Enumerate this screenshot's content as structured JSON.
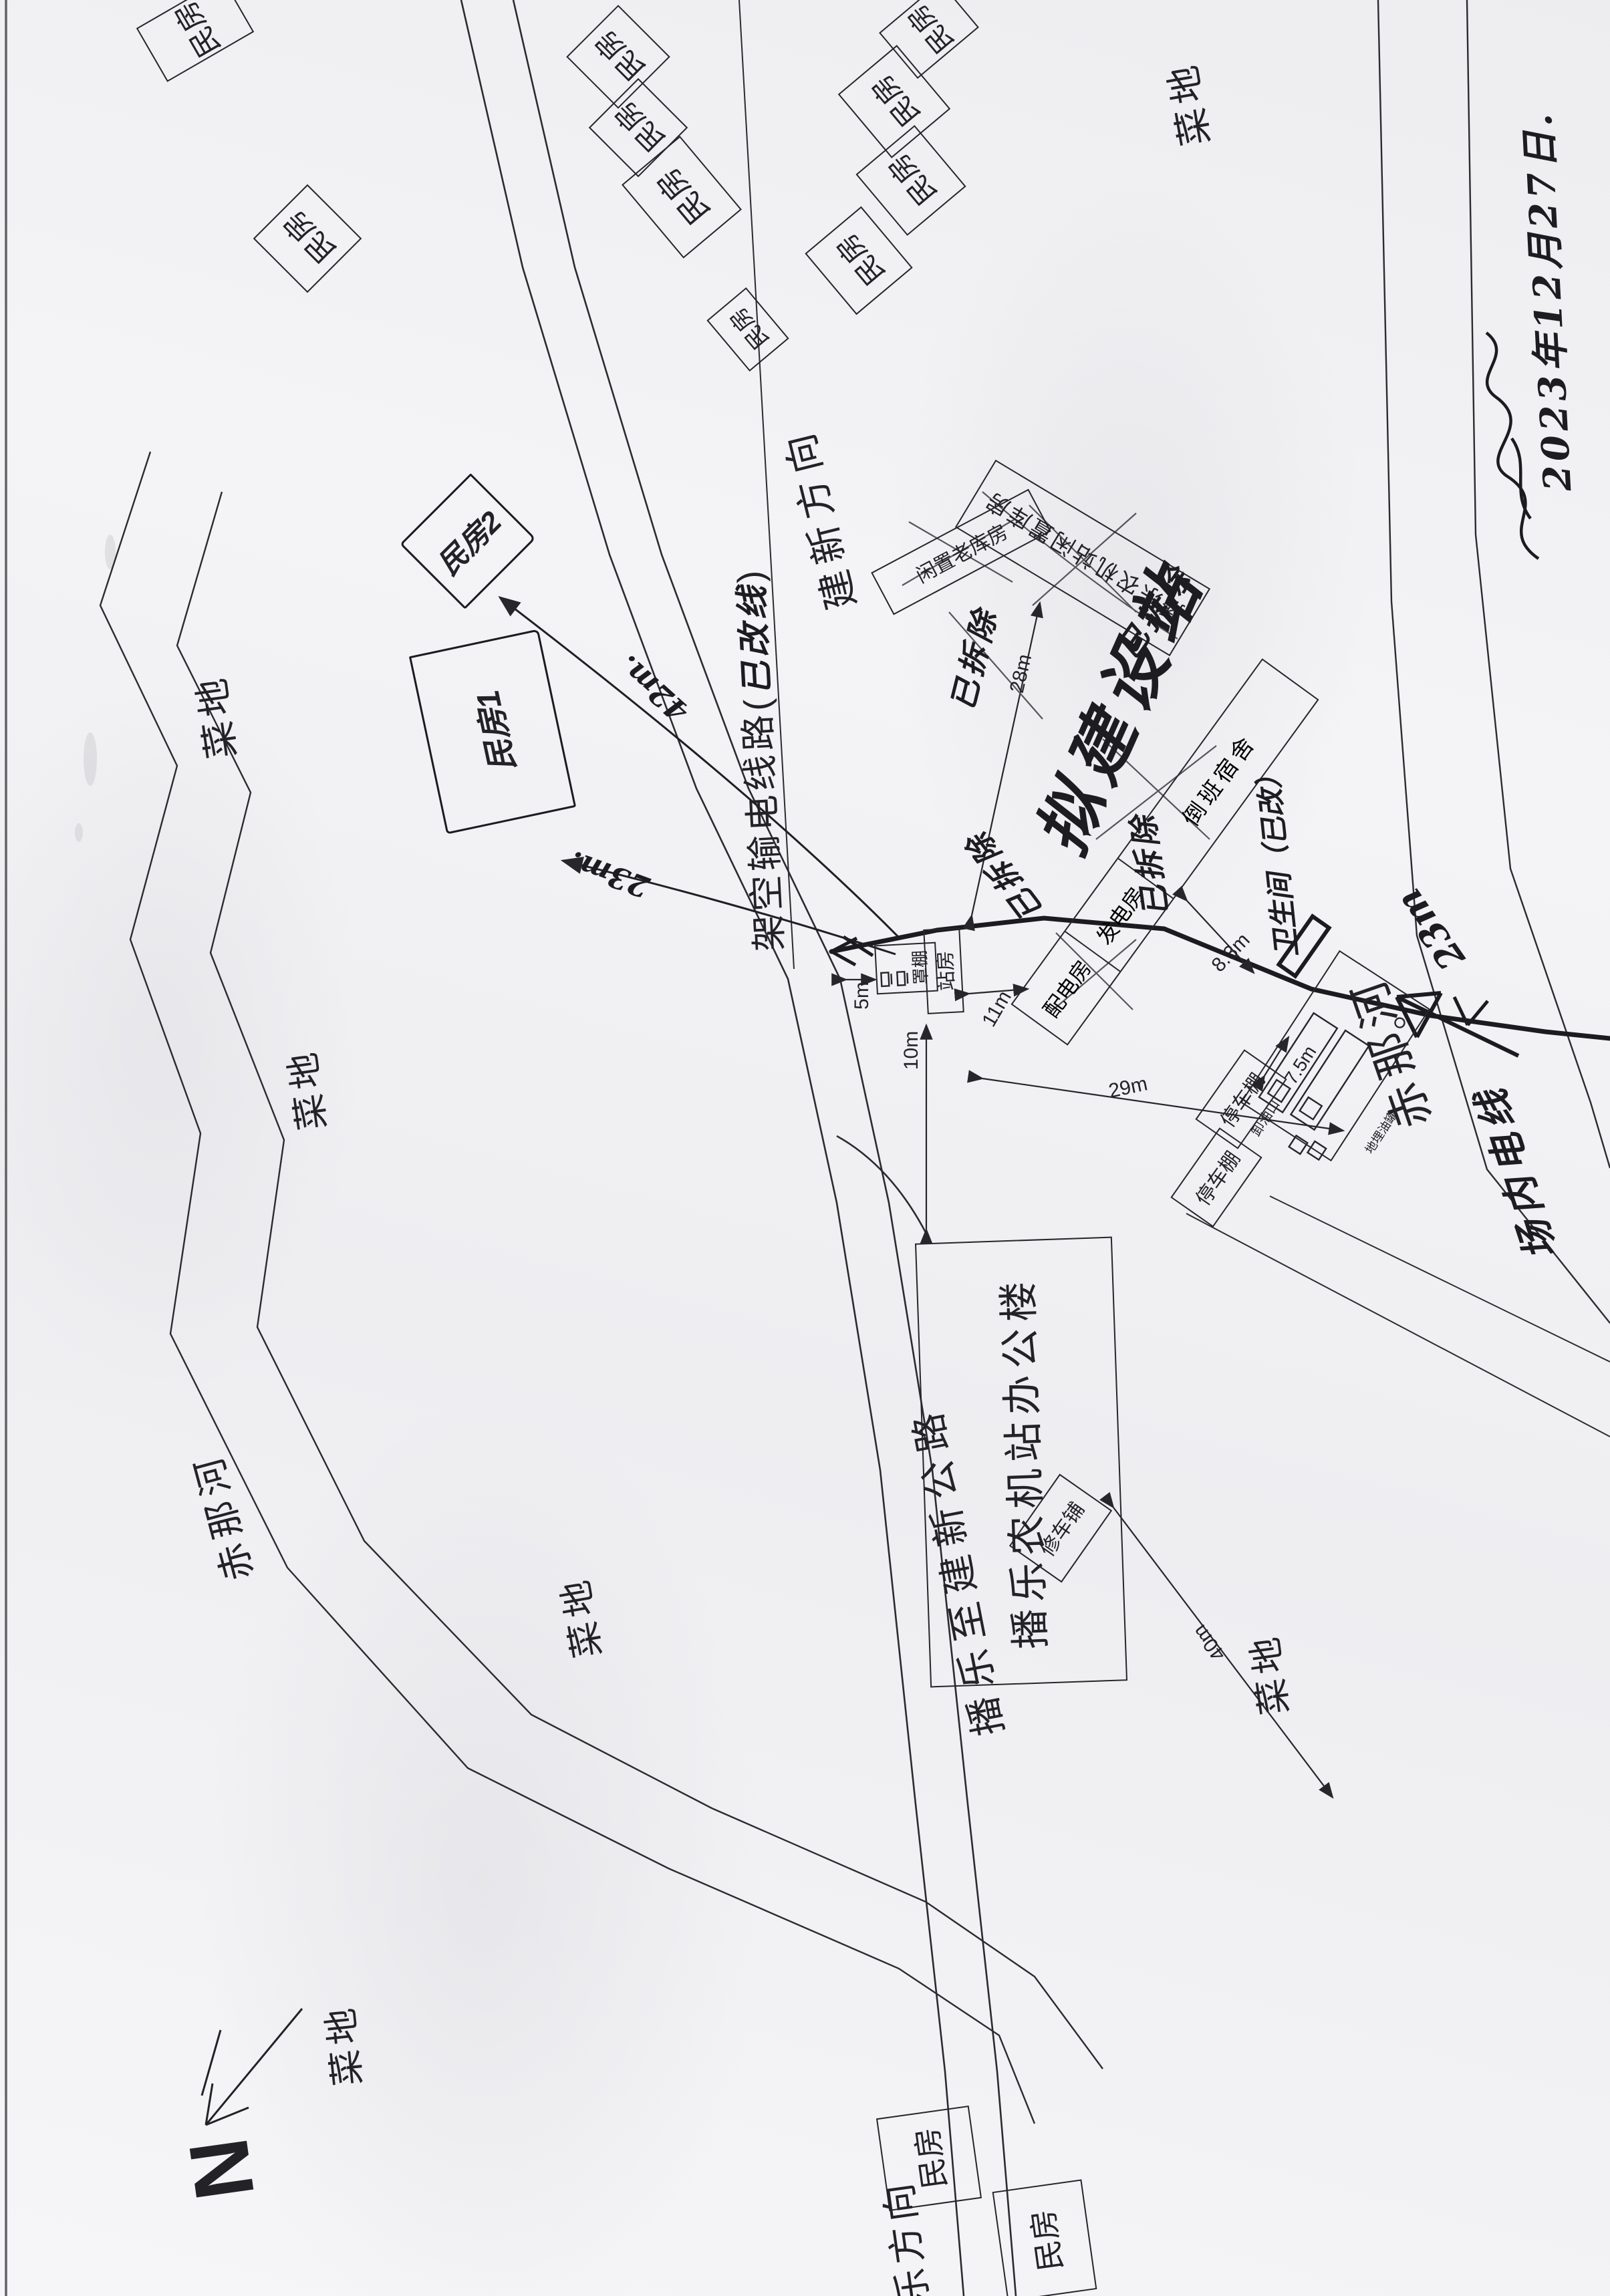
{
  "scan": {
    "date_note": "2023年12月27日.",
    "compass_letter": "N"
  },
  "roads": {
    "main": "播乐至建新公路",
    "to_jianxin": "建新方向",
    "to_le": "乐方向"
  },
  "river_name": "赤那河",
  "field_label": "菜地",
  "house_label": "民房",
  "hand_houses": {
    "h1": "民房1",
    "h2": "民房2"
  },
  "power_line": {
    "printed_open": "架空输电线路(",
    "hand_insert": "已改线",
    "printed_close": ")"
  },
  "station": {
    "office": "播乐农机站办公楼",
    "station_house": "站房",
    "canopy": "罩棚",
    "idle_warehouse_big": "播乐农机站闲置库房",
    "idle_old_warehouse": "闲置老库房",
    "dorm": "倒班宿舍",
    "power_dist_room": "配电房",
    "generator_room": "发电房",
    "parking_shed": "停车棚",
    "repair_shop": "修车铺",
    "unload_port": "卸油口",
    "buried_tanks": "地埋油罐"
  },
  "annotations": {
    "proposed": "拟建设站",
    "demolished": "已拆除",
    "toilet": "卫生间（已改）",
    "site_line": "场内电线",
    "river_dist_hand": "23m",
    "dist_42_hand": "42m.",
    "dist_23_hand": "23m."
  },
  "dimensions": {
    "d5": "5m",
    "d10": "10m",
    "d11": "11m",
    "d28": "28m",
    "d83": "8.3m",
    "d29": "29m",
    "d75": "7.5m",
    "d40": "40m"
  }
}
